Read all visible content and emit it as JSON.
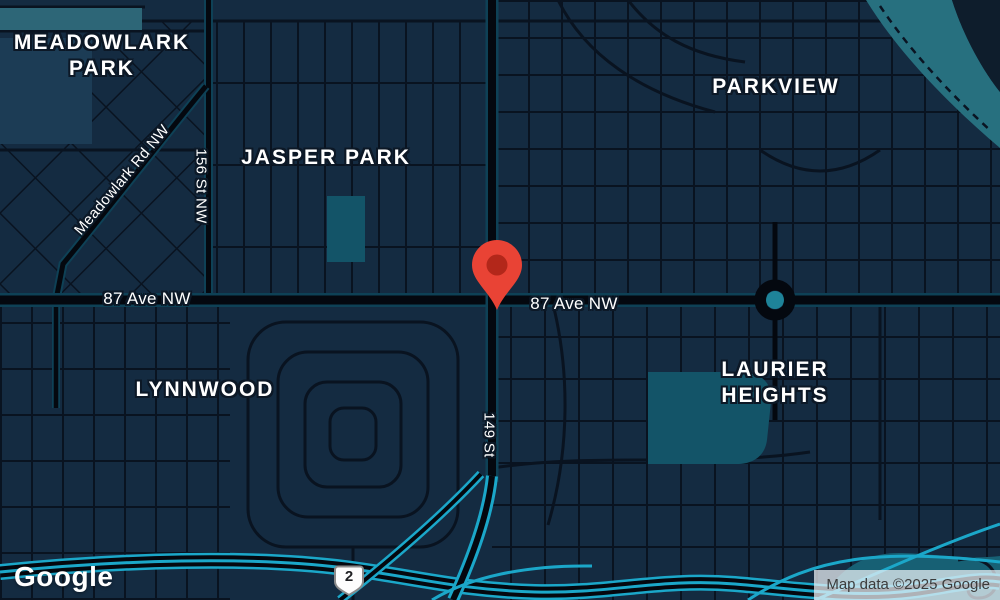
{
  "colors": {
    "map_background": "#142b41",
    "street": "#091320",
    "major_road": "#04080f",
    "major_road_edge": "#0e4156",
    "freeway_accent": "#1ba7c9",
    "park_teal": "#135468",
    "river_teal": "#27707f",
    "pin_red": "#e94335",
    "pin_inner_red": "#b3271a"
  },
  "icons": {
    "marker": "red-location-pin",
    "roundabout": "traffic-circle"
  },
  "neighborhoods": {
    "meadowlark": {
      "line1": "MEADOWLARK",
      "line2": "PARK"
    },
    "jasper": {
      "line1": "JASPER PARK"
    },
    "parkview": {
      "line1": "PARKVIEW"
    },
    "lynnwood": {
      "line1": "LYNNWOOD"
    },
    "laurier": {
      "line1": "LAURIER",
      "line2": "HEIGHTS"
    }
  },
  "roads": {
    "ave87_west": "87 Ave NW",
    "ave87_east": "87 Ave NW",
    "meadowlark_rd": "Meadowlark Rd NW",
    "st156": "156 St NW",
    "st149": "149 St"
  },
  "shield": {
    "route": "2"
  },
  "footer": {
    "logo": "Google",
    "attribution": "Map data ©2025 Google"
  }
}
